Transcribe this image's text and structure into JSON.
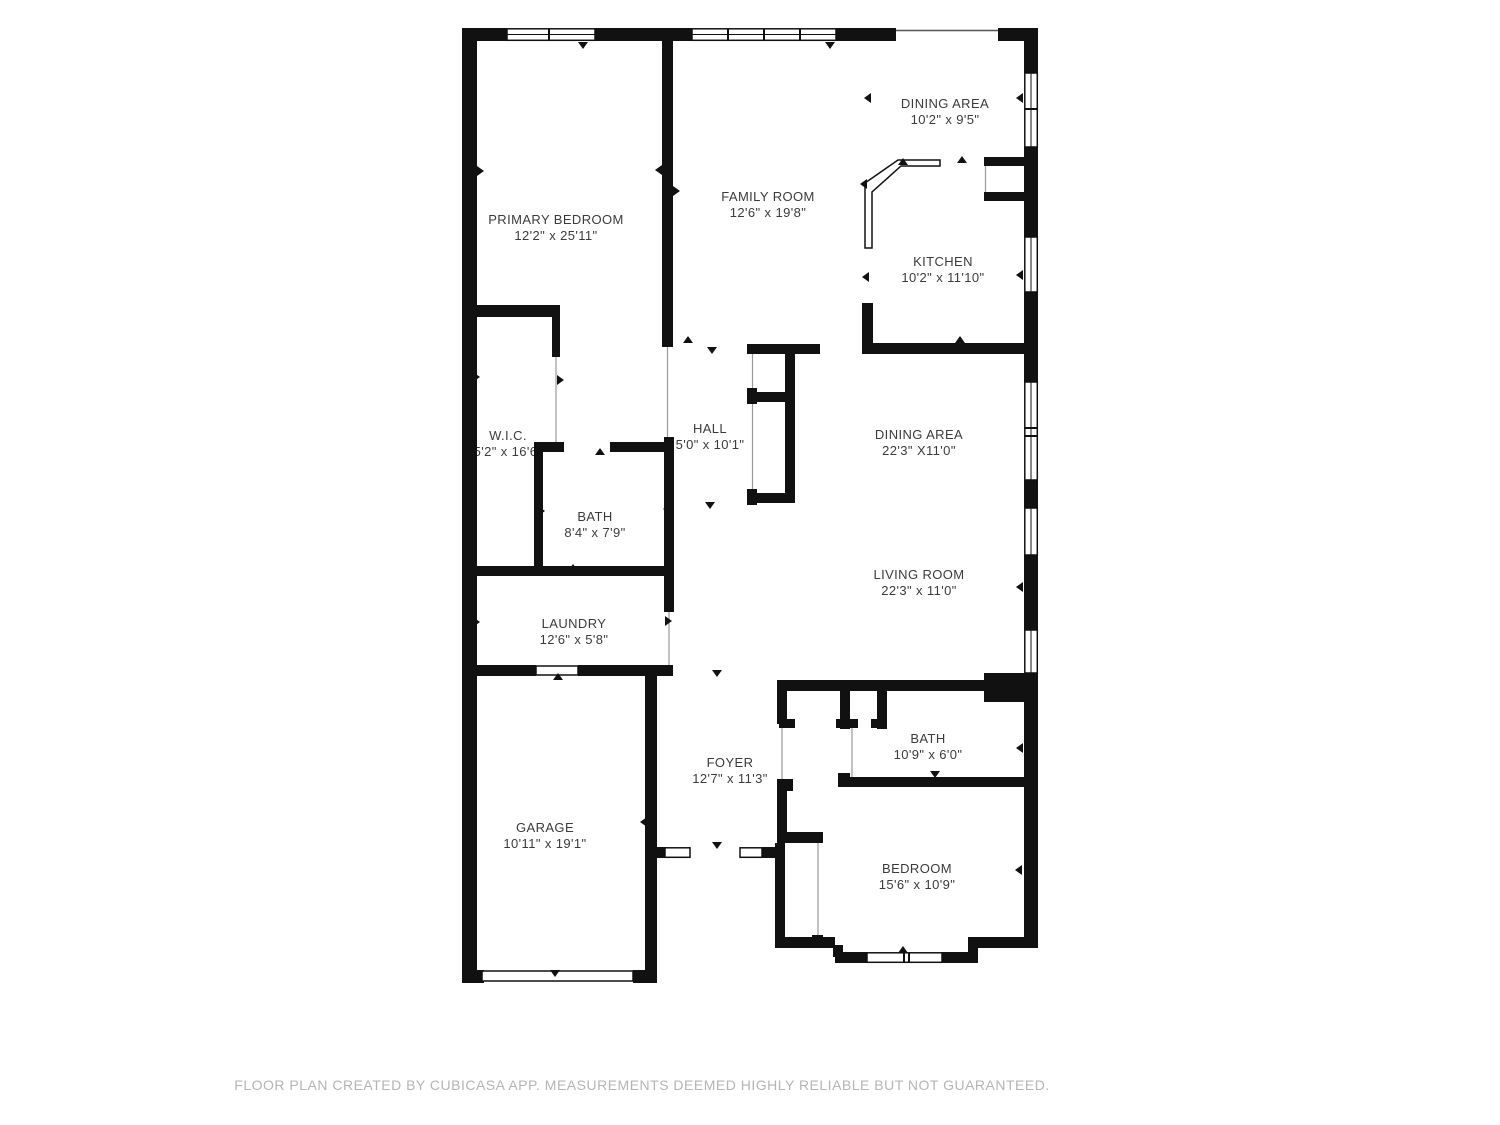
{
  "title": "Floor plan",
  "colors": {
    "wall": "#111111",
    "label": "#3b3b3b",
    "footer": "#b5b5b5",
    "background": "#ffffff"
  },
  "rooms": [
    {
      "id": "dining-area-top",
      "name": "DINING AREA",
      "dims": "10'2\" x 9'5\""
    },
    {
      "id": "family-room",
      "name": "FAMILY ROOM",
      "dims": "12'6\" x 19'8\""
    },
    {
      "id": "primary-bedroom",
      "name": "PRIMARY BEDROOM",
      "dims": "12'2\" x 25'11\""
    },
    {
      "id": "kitchen",
      "name": "KITCHEN",
      "dims": "10'2\" x 11'10\""
    },
    {
      "id": "wic",
      "name": "W.I.C.",
      "dims": "5'2\" x 16'6\""
    },
    {
      "id": "hall",
      "name": "HALL",
      "dims": "5'0\" x 10'1\""
    },
    {
      "id": "dining-area-main",
      "name": "DINING AREA",
      "dims": "22'3\" X11'0\""
    },
    {
      "id": "bath-upper",
      "name": "BATH",
      "dims": "8'4\" x 7'9\""
    },
    {
      "id": "living-room",
      "name": "LIVING ROOM",
      "dims": "22'3\" x 11'0\""
    },
    {
      "id": "laundry",
      "name": "LAUNDRY",
      "dims": "12'6\" x 5'8\""
    },
    {
      "id": "bath-lower",
      "name": "BATH",
      "dims": "10'9\" x 6'0\""
    },
    {
      "id": "foyer",
      "name": "FOYER",
      "dims": "12'7\" x 11'3\""
    },
    {
      "id": "garage",
      "name": "GARAGE",
      "dims": "10'11\" x 19'1\""
    },
    {
      "id": "bedroom",
      "name": "BEDROOM",
      "dims": "15'6\" x 10'9\""
    }
  ],
  "footer": {
    "text": "FLOOR PLAN CREATED BY CUBICASA APP. MEASUREMENTS DEEMED HIGHLY RELIABLE BUT NOT GUARANTEED."
  }
}
